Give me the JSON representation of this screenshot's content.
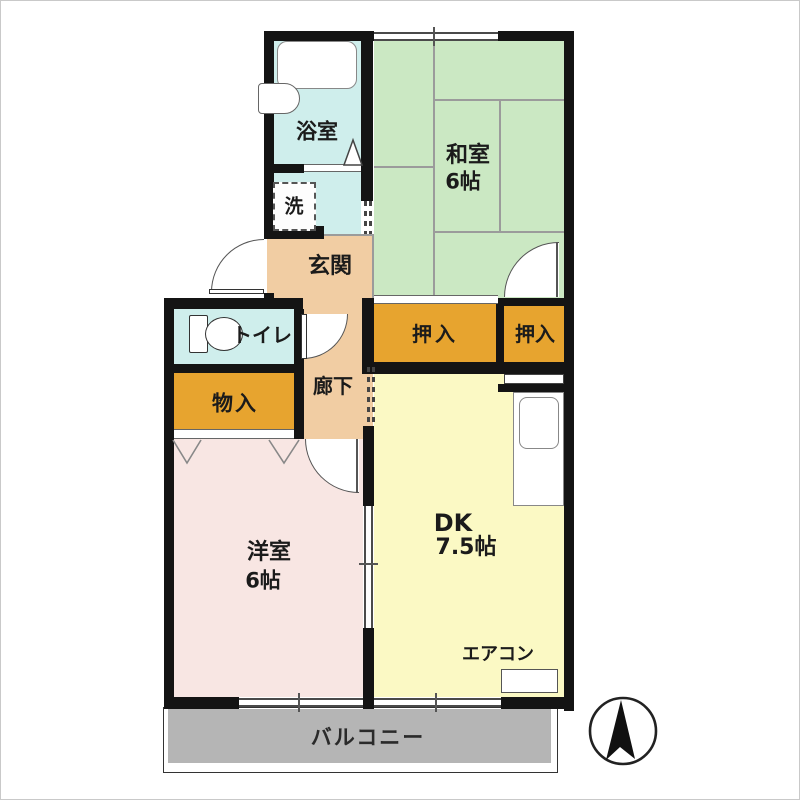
{
  "plan_title": "apartment-floor-plan",
  "colors": {
    "tatami_green": "#cbe8c3",
    "wet_area_cyan": "#cfeeec",
    "hall_beige": "#f1cda3",
    "closet_orange": "#e7a42f",
    "bedroom_pink": "#f8e6e3",
    "dk_yellow": "#fbf9c4",
    "balcony_gray": "#b5b5b5",
    "wall_black": "#141414"
  },
  "rooms": {
    "bathroom": {
      "label": "浴室"
    },
    "laundry": {
      "label": "洗"
    },
    "entrance": {
      "label": "玄関"
    },
    "toilet": {
      "label": "トイレ"
    },
    "storage": {
      "label": "物入"
    },
    "hallway": {
      "label": "廊下"
    },
    "closet_left": {
      "label": "押入"
    },
    "closet_right": {
      "label": "押入"
    },
    "washitsu": {
      "label": "和室",
      "size": "6帖"
    },
    "youshitsu": {
      "label": "洋室",
      "size": "6帖"
    },
    "dk": {
      "label": "DK",
      "size": "7.5帖"
    },
    "balcony": {
      "label": "バルコニー"
    },
    "aircon": {
      "label": "エアコン"
    }
  },
  "compass": {
    "icon": "north-arrow"
  }
}
